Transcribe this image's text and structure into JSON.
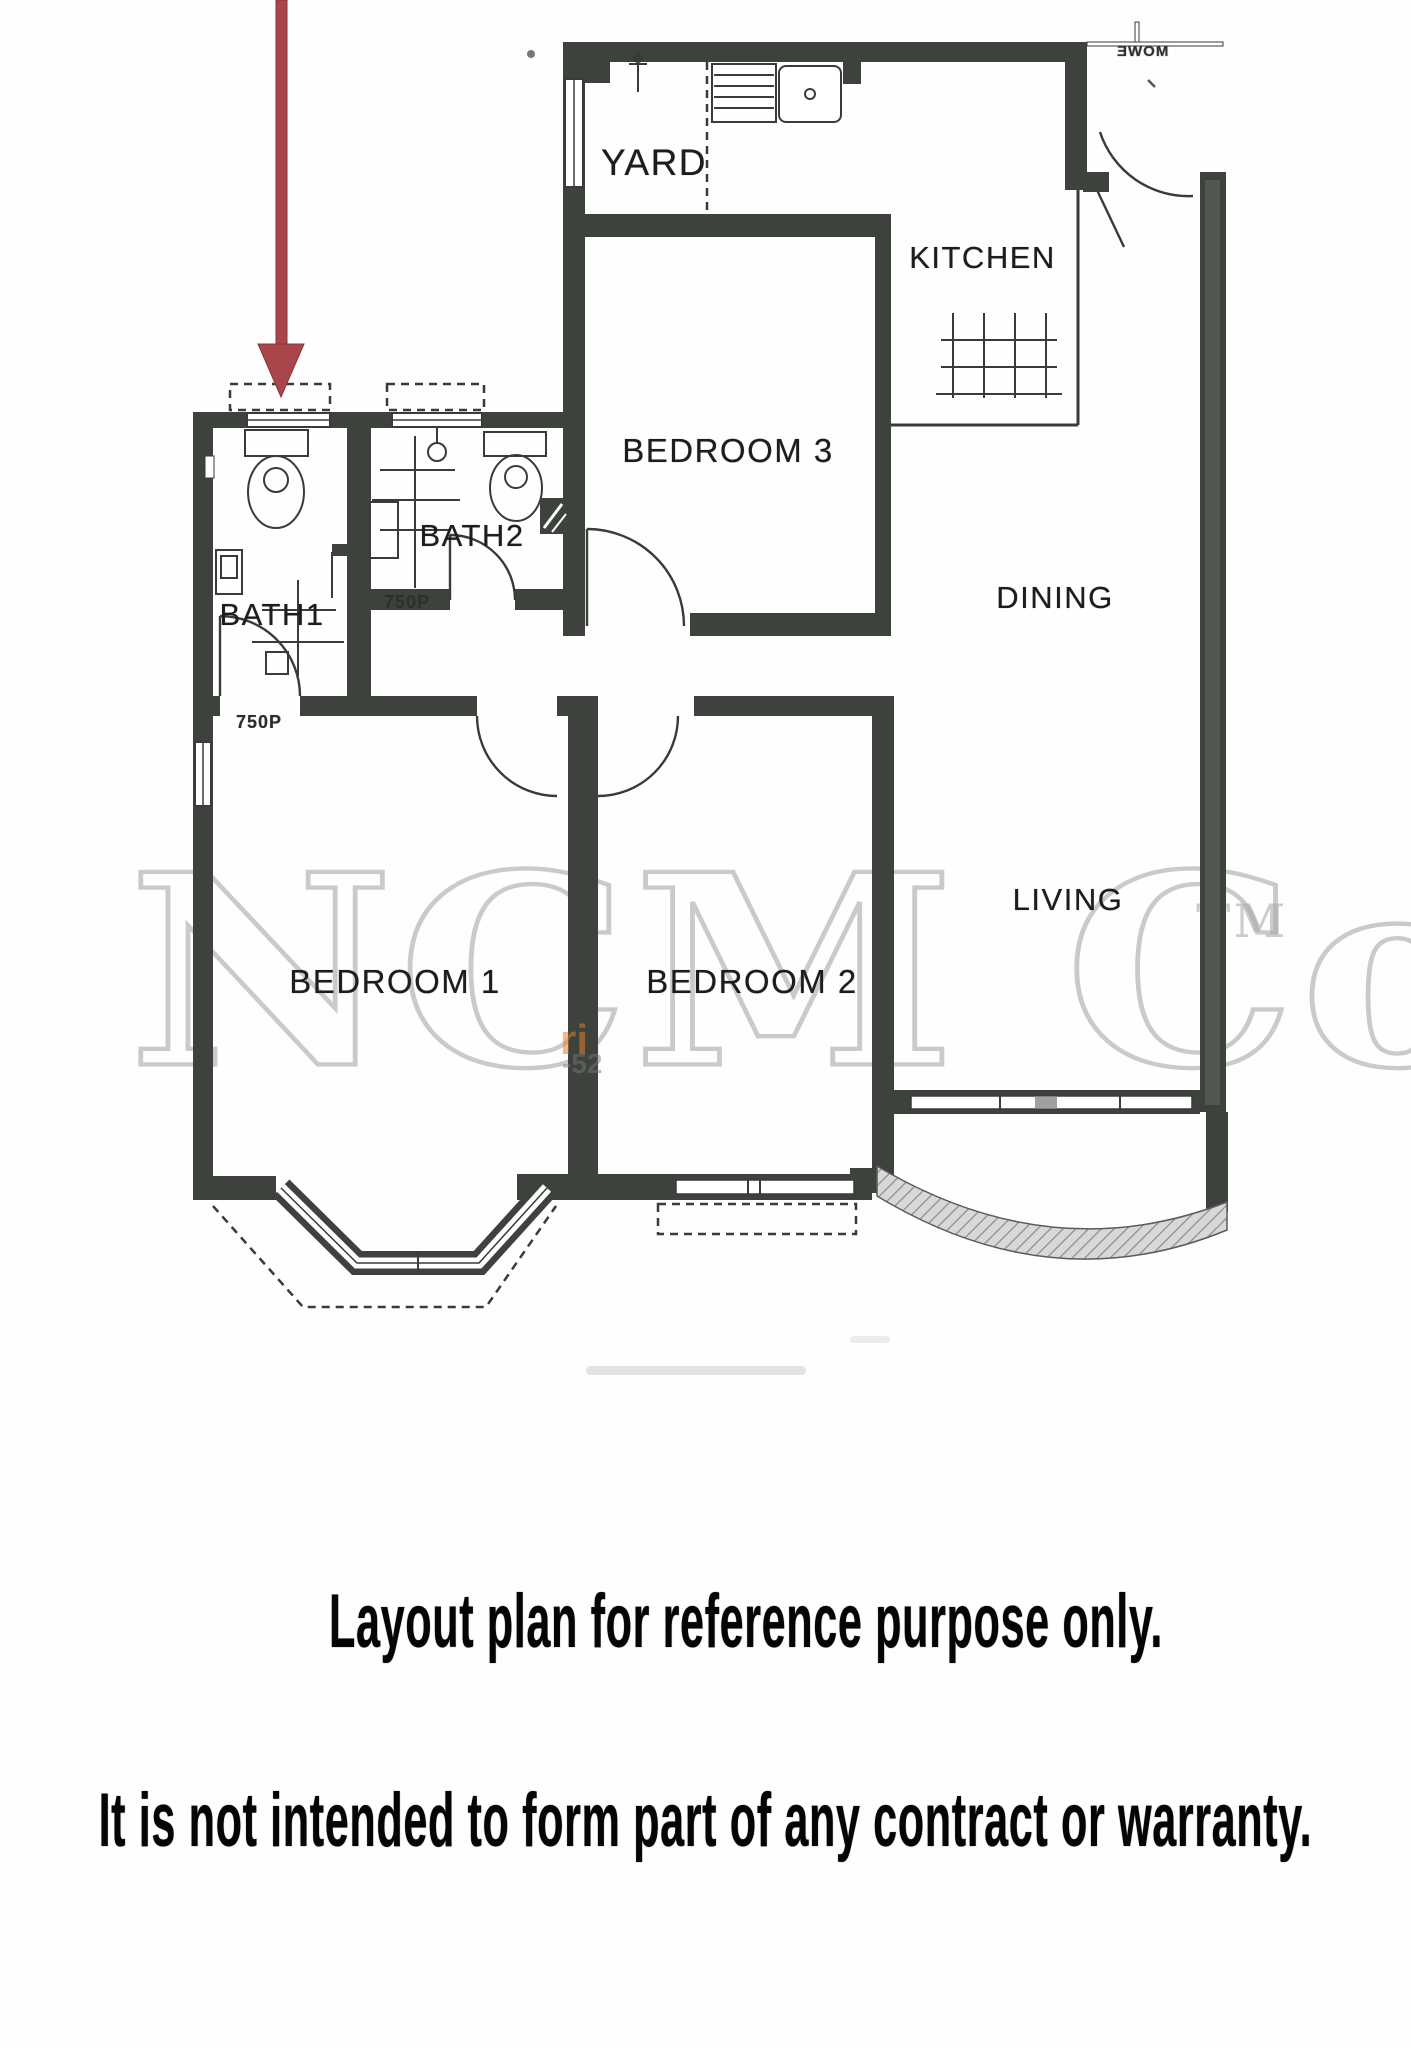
{
  "plan": {
    "rooms": {
      "yard": "YARD",
      "kitchen": "KITCHEN",
      "bedroom3": "BEDROOM 3",
      "dining": "DINING",
      "bath2": "BATH2",
      "bath1": "BATH1",
      "bedroom1": "BEDROOM 1",
      "bedroom2": "BEDROOM 2",
      "living": "LIVING"
    },
    "drain_labels": {
      "bath2": "750P",
      "bath1": "750P"
    },
    "neighbor_unit_text": "ƎWOM"
  },
  "watermark": {
    "text": "NCM Co",
    "trademark": "TM",
    "fragment_orange": "ri",
    "fragment_gray": "-52"
  },
  "captions": {
    "line1": "Layout plan for reference purpose only.",
    "line2": "It is not intended to form part of any contract or warranty."
  },
  "colors": {
    "wall": "#3d423d",
    "line": "#3a3a3a",
    "arrow": "#a8464c",
    "watermark": "#ababab",
    "paper": "#fefefe"
  }
}
